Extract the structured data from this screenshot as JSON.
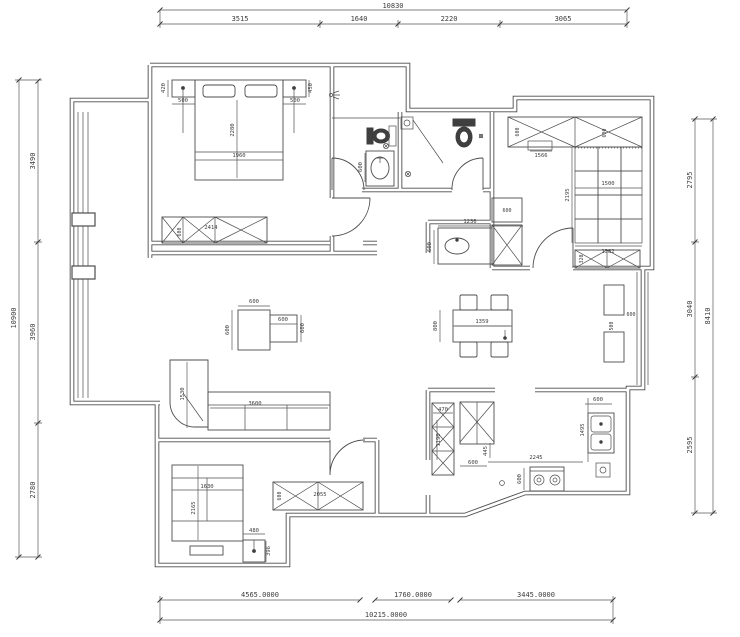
{
  "drawing": {
    "dims_top": {
      "overall": "10830",
      "seg1": "3515",
      "seg2": "1640",
      "seg3": "2220",
      "seg4": "3065"
    },
    "dims_left": {
      "overall": "10900",
      "seg1": "3490",
      "seg2": "3960",
      "seg3": "2780"
    },
    "dims_right": {
      "overall": "8410",
      "seg1": "2795",
      "seg2": "3040",
      "seg3": "2595"
    },
    "dims_bottom": {
      "overall": "10215.0000",
      "seg1": "4565.0000",
      "seg2": "1760.0000",
      "seg3": "3445.0000"
    },
    "master_bedroom": {
      "nightstand_depth_left": "420",
      "nightstand_left": "500",
      "nightstand_right": "500",
      "nightstand_depth_right": "450",
      "bed_length": "2280",
      "bed_width": "1960",
      "wardrobe_width": "2414",
      "wardrobe_depth": "600"
    },
    "bathroom": {
      "vanity_depth": "600"
    },
    "living_room": {
      "sofa_depth": "1530",
      "sofa_length": "3600",
      "table_width": "600",
      "table_height": "600",
      "side_table_width": "600",
      "side_table_height": "600"
    },
    "dining": {
      "table_length": "1359",
      "table_depth": "800",
      "counter_width": "1236",
      "counter_depth": "600",
      "fridge_width": "600",
      "cabinet_width": "600",
      "cabinet_depth": "500"
    },
    "entry": {
      "wardrobe_depth_left": "600",
      "wardrobe_depth_right": "600",
      "cabinet_width": "1566",
      "hall_width": "1500",
      "hall_length": "2195",
      "hall_bottom_width": "1382",
      "shoe_cabinet_depth": "320"
    },
    "kitchen": {
      "cabinet_width": "470",
      "cabinet_height": "1190",
      "dim_445": "445",
      "counter_depth": "600",
      "counter_length": "2245",
      "counter_side": "1495",
      "counter_top": "600",
      "stove_depth": "600"
    },
    "bedroom2": {
      "bed_width": "1630",
      "bed_length": "2165",
      "nightstand_width": "480",
      "nightstand_depth": "396",
      "wardrobe_width": "2055",
      "wardrobe_depth": "600"
    }
  }
}
